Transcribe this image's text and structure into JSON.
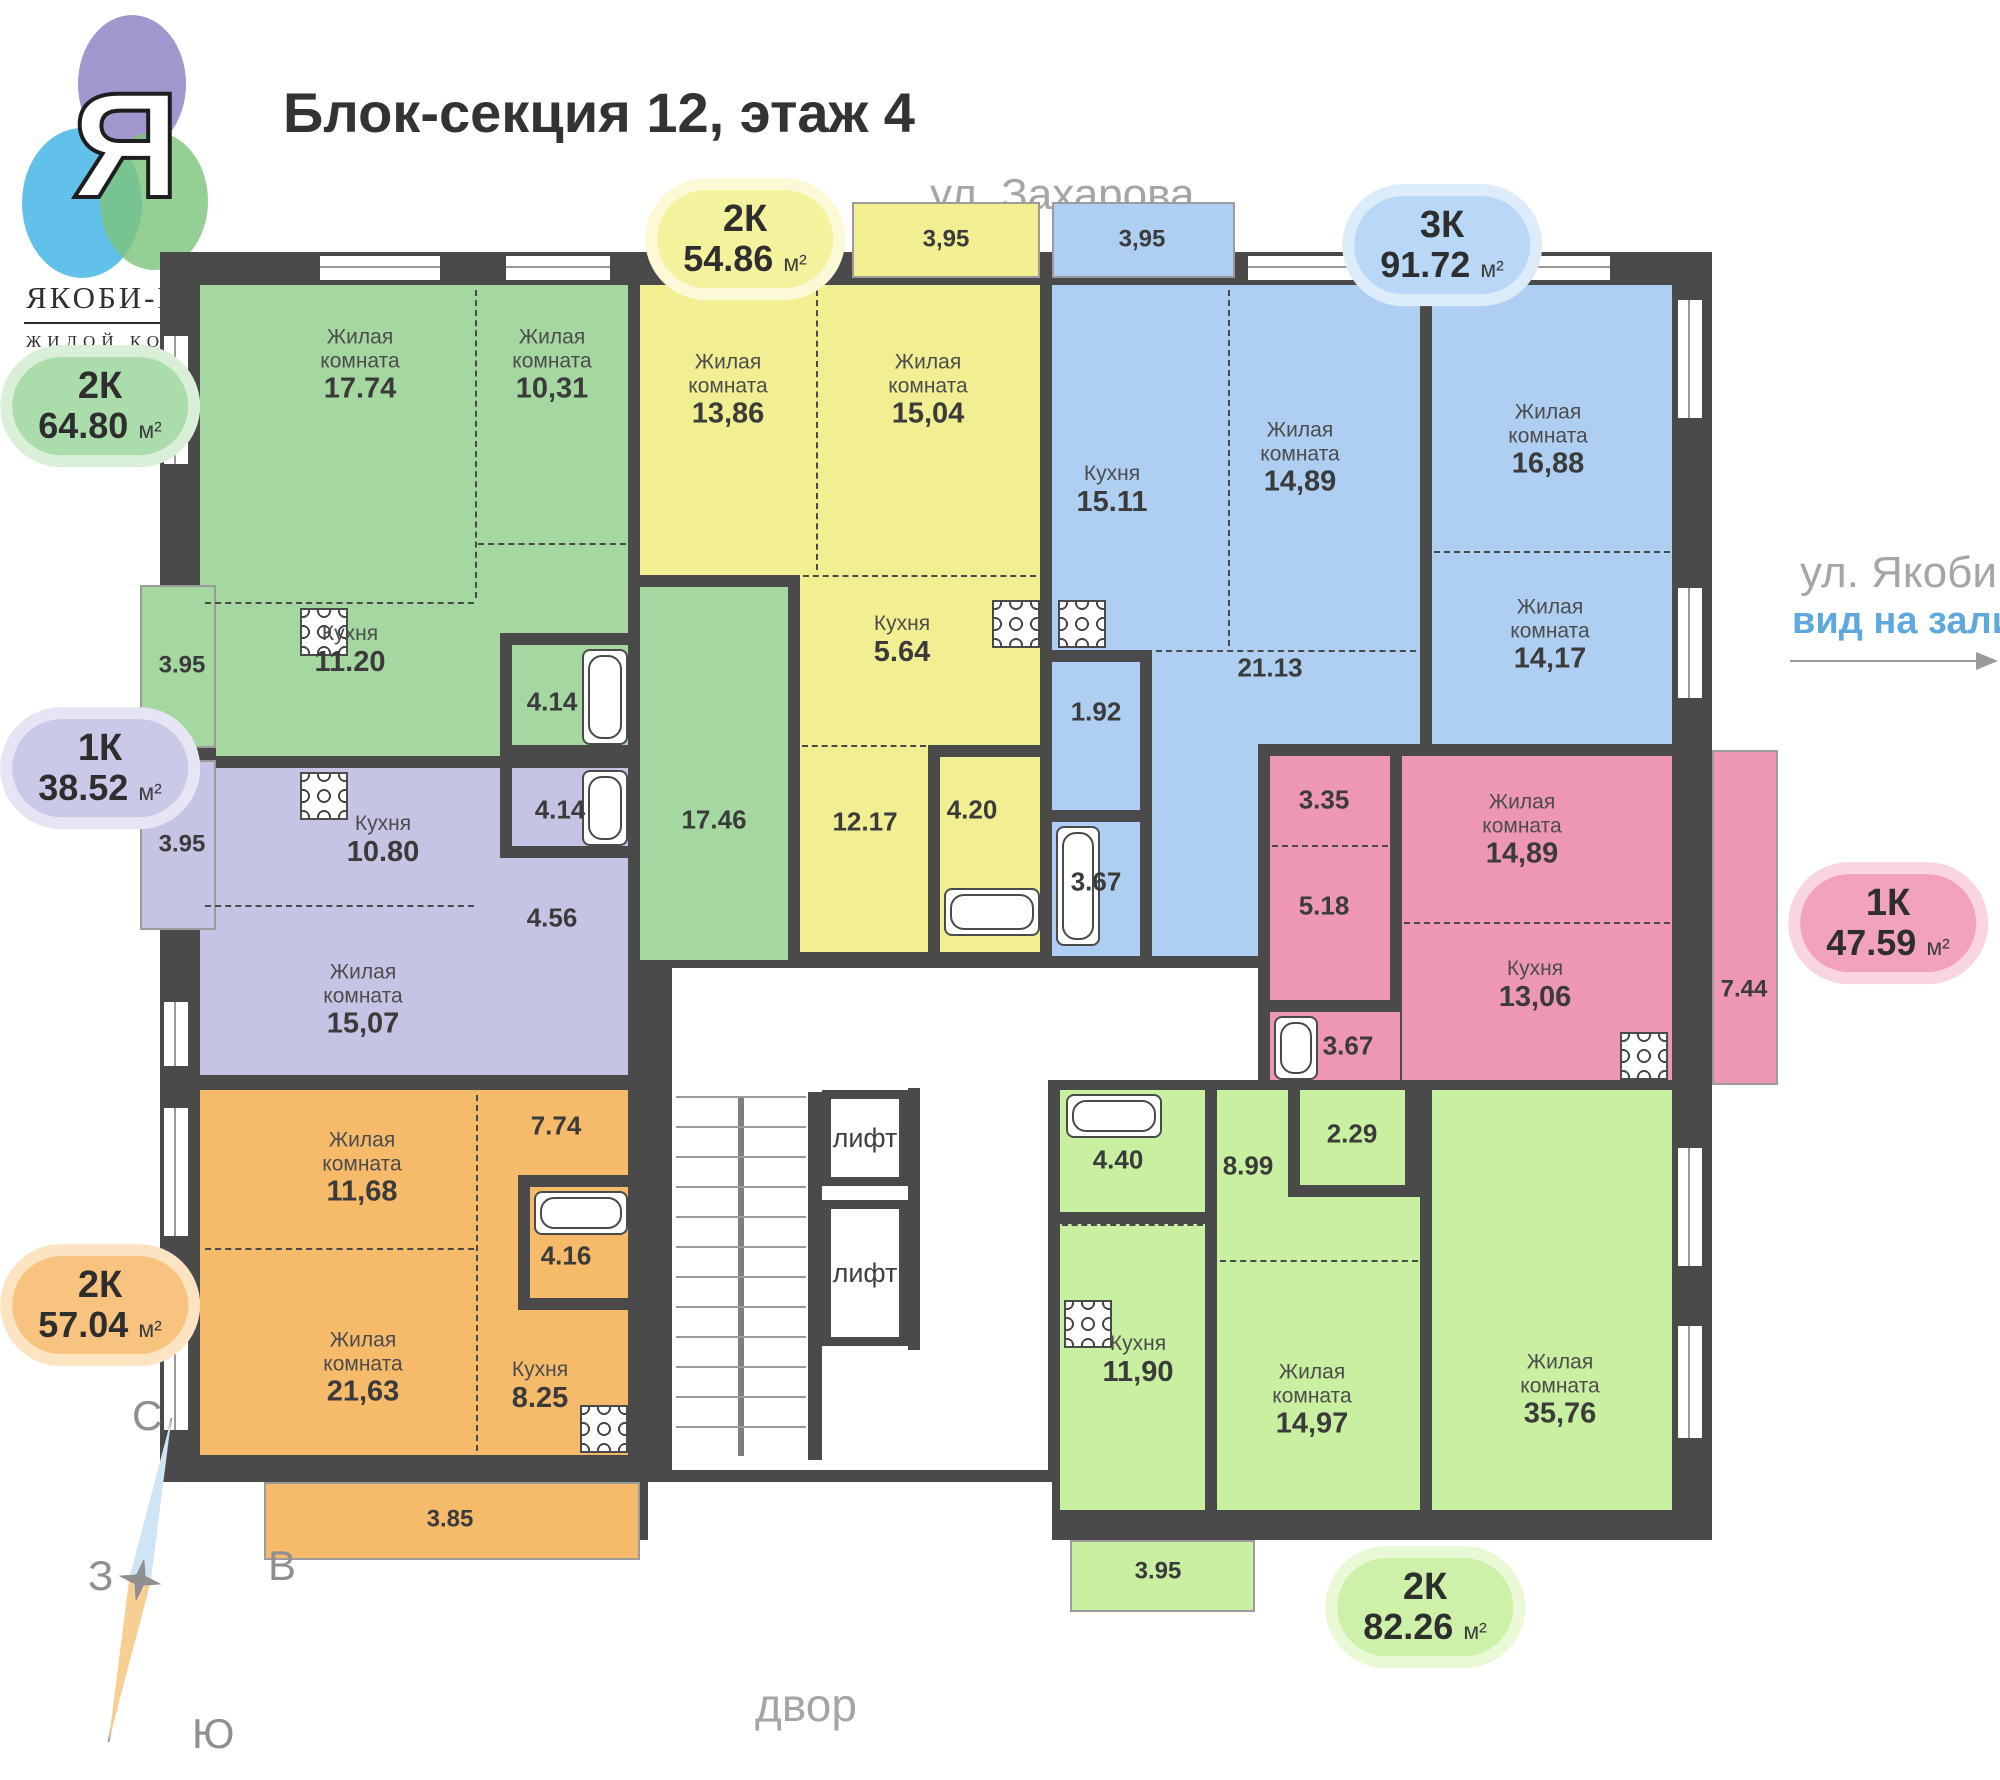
{
  "logo": {
    "letter": "Я",
    "name": "ЯКОБИ-ПАРК",
    "subtitle": "ЖИЛОЙ КОМПЛЕКС"
  },
  "header": {
    "title": "Блок-секция 12, этаж 4"
  },
  "surroundings": {
    "street_top": "ул. Захарова",
    "street_right": "ул. Якоби",
    "street_right_view": "вид на залив",
    "yard": "двор"
  },
  "compass": {
    "north": "С",
    "south": "Ю",
    "west": "З",
    "east": "В"
  },
  "core": {
    "elevator1": "лифт",
    "elevator2": "лифт"
  },
  "colors": {
    "wall": "#4a4a4a",
    "window_line": "#9a9a9a",
    "view_accent": "#5da9dd"
  },
  "apartments": [
    {
      "id": "green",
      "type": "2К",
      "area": "64.80",
      "unit": "м²",
      "color": "#A5D8A1",
      "badge_bg": "#abdcab",
      "badge_halo": "#d9efd7",
      "rooms": [
        {
          "name": "Жилая\nкомната",
          "area": "17.74"
        },
        {
          "name": "Жилая\nкомната",
          "area": "10,31"
        },
        {
          "name": "Кухня",
          "area": "11.20"
        },
        {
          "name": "",
          "area": "4.14"
        },
        {
          "name": "",
          "area": "17.46"
        },
        {
          "name": "",
          "area": "3.95"
        }
      ]
    },
    {
      "id": "yellow",
      "type": "2К",
      "area": "54.86",
      "unit": "м²",
      "color": "#F2EF93",
      "badge_bg": "#f5f29e",
      "badge_halo": "#fbf9d6",
      "rooms": [
        {
          "name": "Жилая\nкомната",
          "area": "13,86"
        },
        {
          "name": "Жилая\nкомната",
          "area": "15,04"
        },
        {
          "name": "Кухня",
          "area": "5.64"
        },
        {
          "name": "",
          "area": "12.17"
        },
        {
          "name": "",
          "area": "4.20"
        },
        {
          "name": "",
          "area": "3,95"
        }
      ]
    },
    {
      "id": "blue",
      "type": "3К",
      "area": "91.72",
      "unit": "м²",
      "color": "#AECFF1",
      "badge_bg": "#b9d7f6",
      "badge_halo": "#ddecfb",
      "rooms": [
        {
          "name": "Кухня",
          "area": "15.11"
        },
        {
          "name": "Жилая\nкомната",
          "area": "14,89"
        },
        {
          "name": "Жилая\nкомната",
          "area": "16,88"
        },
        {
          "name": "Жилая\nкомната",
          "area": "14,17"
        },
        {
          "name": "",
          "area": "21.13"
        },
        {
          "name": "",
          "area": "1.92"
        },
        {
          "name": "",
          "area": "3.67"
        },
        {
          "name": "",
          "area": "3,95"
        }
      ]
    },
    {
      "id": "pink",
      "type": "1К",
      "area": "47.59",
      "unit": "м²",
      "color": "#EE97B5",
      "badge_bg": "#f2a2bf",
      "badge_halo": "#f9d5e2",
      "rooms": [
        {
          "name": "",
          "area": "3.35"
        },
        {
          "name": "",
          "area": "5.18"
        },
        {
          "name": "Жилая\nкомната",
          "area": "14,89"
        },
        {
          "name": "Кухня",
          "area": "13,06"
        },
        {
          "name": "",
          "area": "3.67"
        },
        {
          "name": "",
          "area": "7.44"
        }
      ]
    },
    {
      "id": "purple",
      "type": "1К",
      "area": "38.52",
      "unit": "м²",
      "color": "#C6C4E4",
      "badge_bg": "#cbc9e8",
      "badge_halo": "#e6e5f4",
      "rooms": [
        {
          "name": "Кухня",
          "area": "10.80"
        },
        {
          "name": "",
          "area": "4.14"
        },
        {
          "name": "",
          "area": "4.56"
        },
        {
          "name": "Жилая\nкомната",
          "area": "15,07"
        },
        {
          "name": "",
          "area": "3.95"
        }
      ]
    },
    {
      "id": "orange",
      "type": "2К",
      "area": "57.04",
      "unit": "м²",
      "color": "#F6BA6B",
      "badge_bg": "#f8c37e",
      "badge_halo": "#fce4c3",
      "rooms": [
        {
          "name": "Жилая\nкомната",
          "area": "11,68"
        },
        {
          "name": "",
          "area": "7.74"
        },
        {
          "name": "",
          "area": "4.16"
        },
        {
          "name": "Жилая\nкомната",
          "area": "21,63"
        },
        {
          "name": "Кухня",
          "area": "8.25"
        },
        {
          "name": "",
          "area": "3.85"
        }
      ]
    },
    {
      "id": "lightgreen",
      "type": "2К",
      "area": "82.26",
      "unit": "м²",
      "color": "#C9F0A0",
      "badge_bg": "#cdf1a8",
      "badge_halo": "#e9f8d5",
      "rooms": [
        {
          "name": "",
          "area": "4.40"
        },
        {
          "name": "",
          "area": "8.99"
        },
        {
          "name": "",
          "area": "2.29"
        },
        {
          "name": "Кухня",
          "area": "11,90"
        },
        {
          "name": "Жилая\nкомната",
          "area": "14,97"
        },
        {
          "name": "Жилая\nкомната",
          "area": "35,76"
        },
        {
          "name": "",
          "area": "3.95"
        }
      ]
    }
  ]
}
